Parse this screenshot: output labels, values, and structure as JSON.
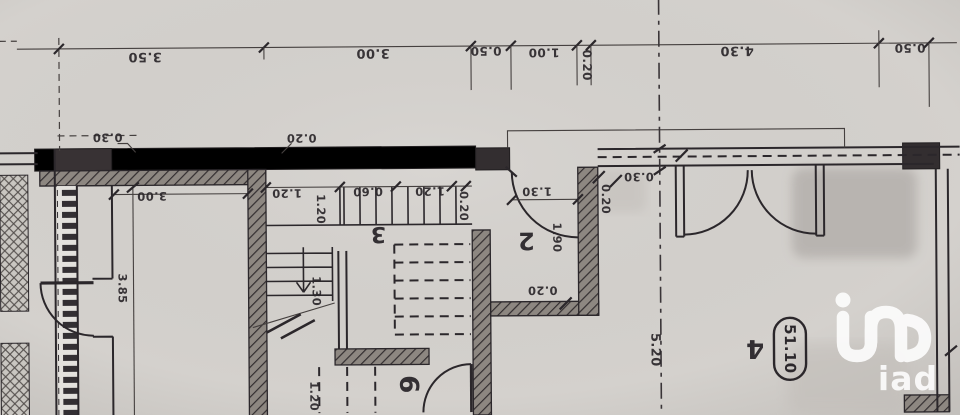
{
  "plan": {
    "colors": {
      "paper": "#d4d1cd",
      "ink": "#2b272b",
      "dimline": "#45403f",
      "watermark": "#ffffff"
    },
    "watermark": {
      "text": "iad"
    },
    "area_badge": {
      "value": "51.10"
    },
    "labels": [
      {
        "kind": "dim",
        "value": "3.50",
        "x": 146,
        "y": 54,
        "rot": 180,
        "fs": 13
      },
      {
        "kind": "dim",
        "value": "3.00",
        "x": 374,
        "y": 52,
        "rot": 180,
        "fs": 13
      },
      {
        "kind": "dim",
        "value": "0.50",
        "x": 487,
        "y": 51,
        "rot": 180,
        "fs": 12
      },
      {
        "kind": "dim",
        "value": "1.00",
        "x": 545,
        "y": 53,
        "rot": 180,
        "fs": 12
      },
      {
        "kind": "dim",
        "value": "0.20",
        "x": 588,
        "y": 66,
        "rot": 90,
        "fs": 12
      },
      {
        "kind": "dim",
        "value": "4.30",
        "x": 738,
        "y": 52,
        "rot": 180,
        "fs": 13
      },
      {
        "kind": "dim",
        "value": "0.50",
        "x": 911,
        "y": 51,
        "rot": 180,
        "fs": 12
      },
      {
        "kind": "dim",
        "value": "0.30",
        "x": 108,
        "y": 135,
        "rot": 180,
        "fs": 11.5
      },
      {
        "kind": "dim",
        "value": "0.20",
        "x": 302,
        "y": 137,
        "rot": 180,
        "fs": 11.5
      },
      {
        "kind": "dim",
        "value": "3.00",
        "x": 152,
        "y": 194,
        "rot": 180,
        "fs": 11.5
      },
      {
        "kind": "dim",
        "value": "3.85",
        "x": 122,
        "y": 286,
        "rot": 90,
        "fs": 11.5
      },
      {
        "kind": "dim",
        "value": "1.20",
        "x": 287,
        "y": 192,
        "rot": 180,
        "fs": 11.5
      },
      {
        "kind": "dim",
        "value": "0.60",
        "x": 368,
        "y": 191,
        "rot": 180,
        "fs": 11.5
      },
      {
        "kind": "dim",
        "value": "1.20",
        "x": 430,
        "y": 191,
        "rot": 180,
        "fs": 11.5
      },
      {
        "kind": "dim",
        "value": "0.20",
        "x": 464,
        "y": 206,
        "rot": 90,
        "fs": 11.5
      },
      {
        "kind": "dim",
        "value": "1.20",
        "x": 321,
        "y": 208,
        "rot": 90,
        "fs": 11.5
      },
      {
        "kind": "dim",
        "value": "1.30",
        "x": 537,
        "y": 192,
        "rot": 180,
        "fs": 11.5
      },
      {
        "kind": "dim",
        "value": "1.90",
        "x": 557,
        "y": 238,
        "rot": 90,
        "fs": 11.5
      },
      {
        "kind": "dim",
        "value": "0.20",
        "x": 606,
        "y": 200,
        "rot": 90,
        "fs": 11.5
      },
      {
        "kind": "dim",
        "value": "0.20",
        "x": 542,
        "y": 291,
        "rot": 180,
        "fs": 11.5
      },
      {
        "kind": "dim",
        "value": "0.30",
        "x": 639,
        "y": 178,
        "rot": 180,
        "fs": 11.5
      },
      {
        "kind": "dim",
        "value": "1.30",
        "x": 316,
        "y": 290,
        "rot": 90,
        "fs": 11.5
      },
      {
        "kind": "dim",
        "value": "1.20",
        "x": 313,
        "y": 395,
        "rot": 90,
        "fs": 11.5
      },
      {
        "kind": "dim",
        "value": "5.20",
        "x": 654,
        "y": 351,
        "rot": 90,
        "fs": 13
      },
      {
        "kind": "room",
        "value": "3",
        "x": 378,
        "y": 233,
        "rot": 180,
        "fs": 22
      },
      {
        "kind": "room",
        "value": "2",
        "x": 526,
        "y": 241,
        "rot": 180,
        "fs": 24
      },
      {
        "kind": "room",
        "value": "4",
        "x": 754,
        "y": 350,
        "rot": 180,
        "fs": 26
      },
      {
        "kind": "room",
        "value": "6",
        "x": 407,
        "y": 384,
        "rot": 90,
        "fs": 26
      }
    ]
  }
}
